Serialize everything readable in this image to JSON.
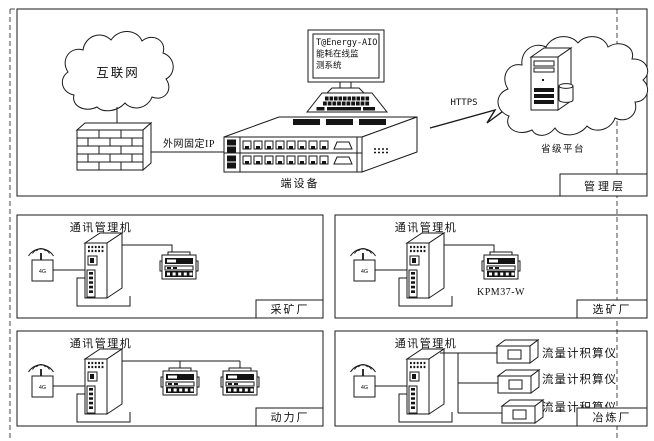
{
  "frame": {
    "management_layer_label": "管理层"
  },
  "top": {
    "internet_cloud_label": "互联网",
    "wan_ip_label": "外网固定IP",
    "terminal_device_label": "端设备",
    "monitor_screen_lines": [
      "T@Energy-AIO",
      "能耗在线监",
      "测系统"
    ],
    "https_label": "HTTPS",
    "province_platform_label": "省级平台"
  },
  "plants": [
    {
      "name": "采矿厂",
      "gateway_label": "通讯管理机",
      "antenna_label": "4G"
    },
    {
      "name": "选矿厂",
      "gateway_label": "通讯管理机",
      "antenna_label": "4G",
      "meter_model": "KPM37-W"
    },
    {
      "name": "动力厂",
      "gateway_label": "通讯管理机",
      "antenna_label": "4G"
    },
    {
      "name": "冶炼厂",
      "gateway_label": "通讯管理机",
      "antenna_label": "4G",
      "flow_meter_labels": [
        "流量计积算仪",
        "流量计积算仪",
        "流量计积算仪"
      ]
    }
  ],
  "colors": {
    "line": "#1a1a1a",
    "dashed_frame": "#4a4a4a",
    "dark_fill": "#141414",
    "background": "#ffffff"
  }
}
